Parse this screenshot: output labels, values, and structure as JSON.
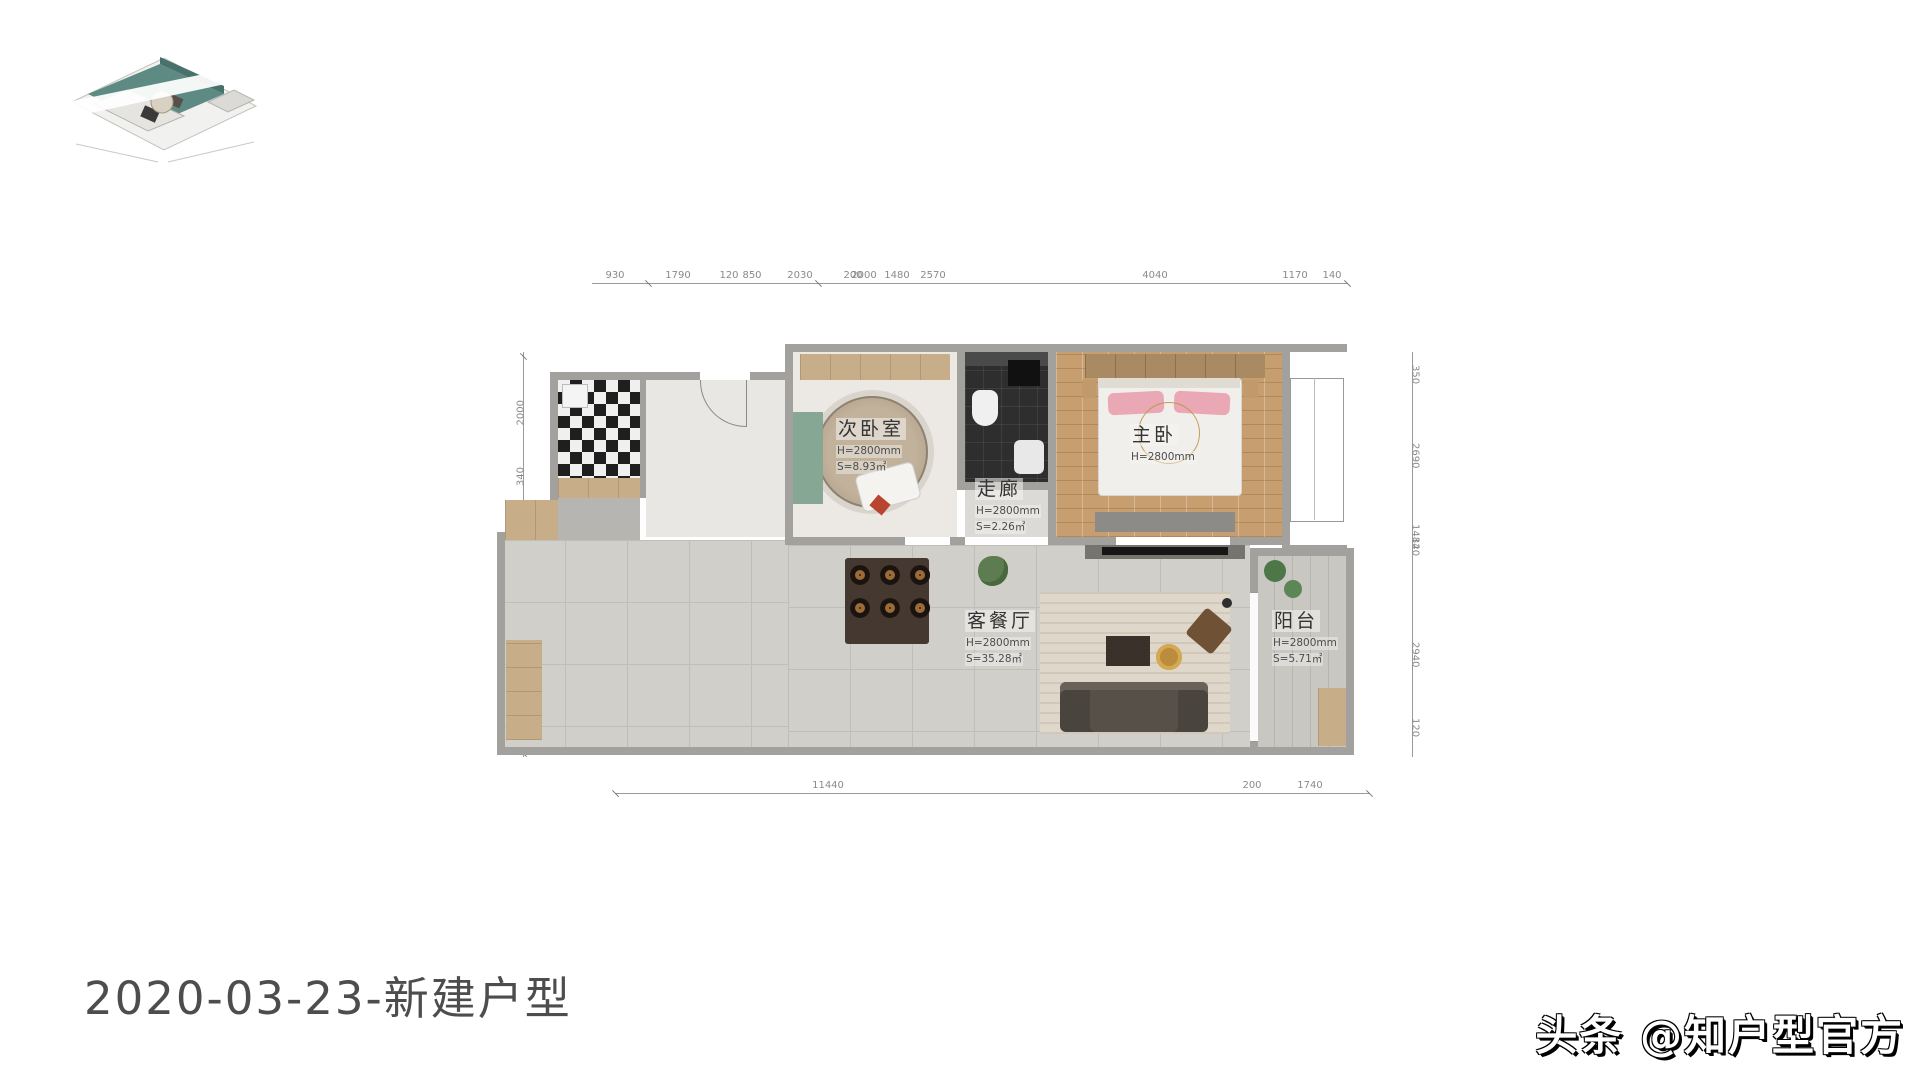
{
  "title": {
    "text": "2020-03-23-新建户型"
  },
  "watermark": {
    "text": "头条 @知户型官方"
  },
  "thumbnail": {
    "label": "3d-floorplan-preview"
  },
  "colors": {
    "wall": "#a3a19d",
    "wood_floor": "#c79e6f",
    "tile_floor": "#d1cfca",
    "dark_tile": "#2e2e2e",
    "cabinet_wood": "#c8ae88",
    "pillow_pink": "#e9a8b4",
    "thumb_teal": "#5d8a82"
  },
  "plan": {
    "rooms": {
      "bedroom2": {
        "name": "次卧室",
        "height": "H=2800mm",
        "area": "S=8.93㎡"
      },
      "corridor": {
        "name": "走廊",
        "height": "H=2800mm",
        "area": "S=2.26㎡"
      },
      "master": {
        "name": "主卧",
        "height": "H=2800mm"
      },
      "living": {
        "name": "客餐厅",
        "height": "H=2800mm",
        "area": "S=35.28㎡"
      },
      "balcony": {
        "name": "阳台",
        "height": "H=2800mm",
        "area": "S=5.71㎡"
      }
    },
    "dims": {
      "top": [
        "930",
        "1790",
        "120",
        "850",
        "2030",
        "200",
        "2000",
        "1480",
        "2570",
        "4040",
        "1170",
        "140"
      ],
      "bottom": [
        "11440",
        "200",
        "1740"
      ],
      "left": [
        "2000",
        "340",
        "2340",
        "1080",
        "30",
        "2360",
        "1180",
        "90"
      ],
      "right": [
        "350",
        "2690",
        "1484",
        "120",
        "2940",
        "120"
      ]
    }
  }
}
